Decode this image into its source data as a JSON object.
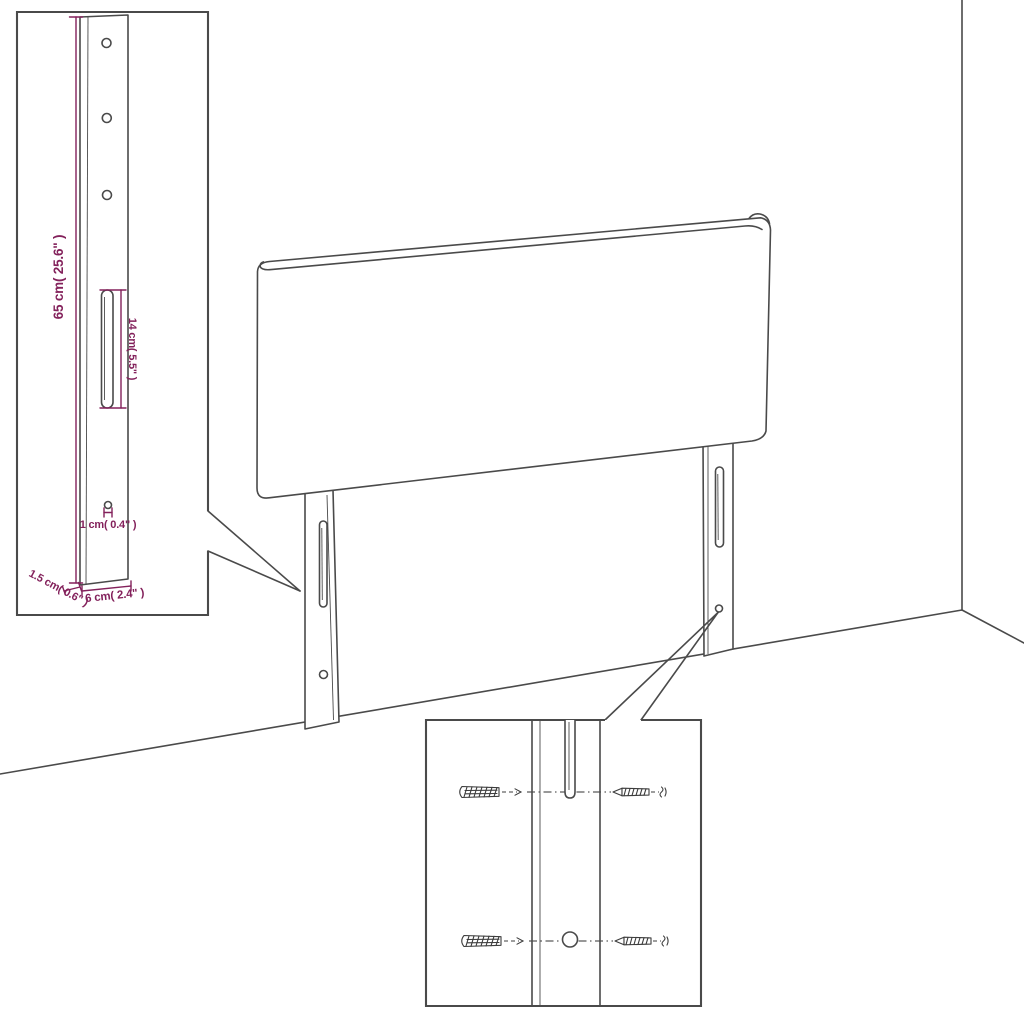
{
  "colors": {
    "line": "#4a4a4a",
    "dimension": "#83215b",
    "background": "#ffffff"
  },
  "bracket_inset": {
    "height_label": "65 cm( 25.6\" )",
    "slot_label": "14 cm( 5.5\" )",
    "hole_label": "1 cm( 0.4\" )",
    "thickness_label": "1.5 cm( 0.6\" )",
    "width_label": "6 cm( 2.4\" )"
  },
  "hardware_inset": {
    "wall_plug_icon": "wall-plug",
    "screw_icon": "screw",
    "wall_plug_count": 2,
    "screw_count": 2
  }
}
